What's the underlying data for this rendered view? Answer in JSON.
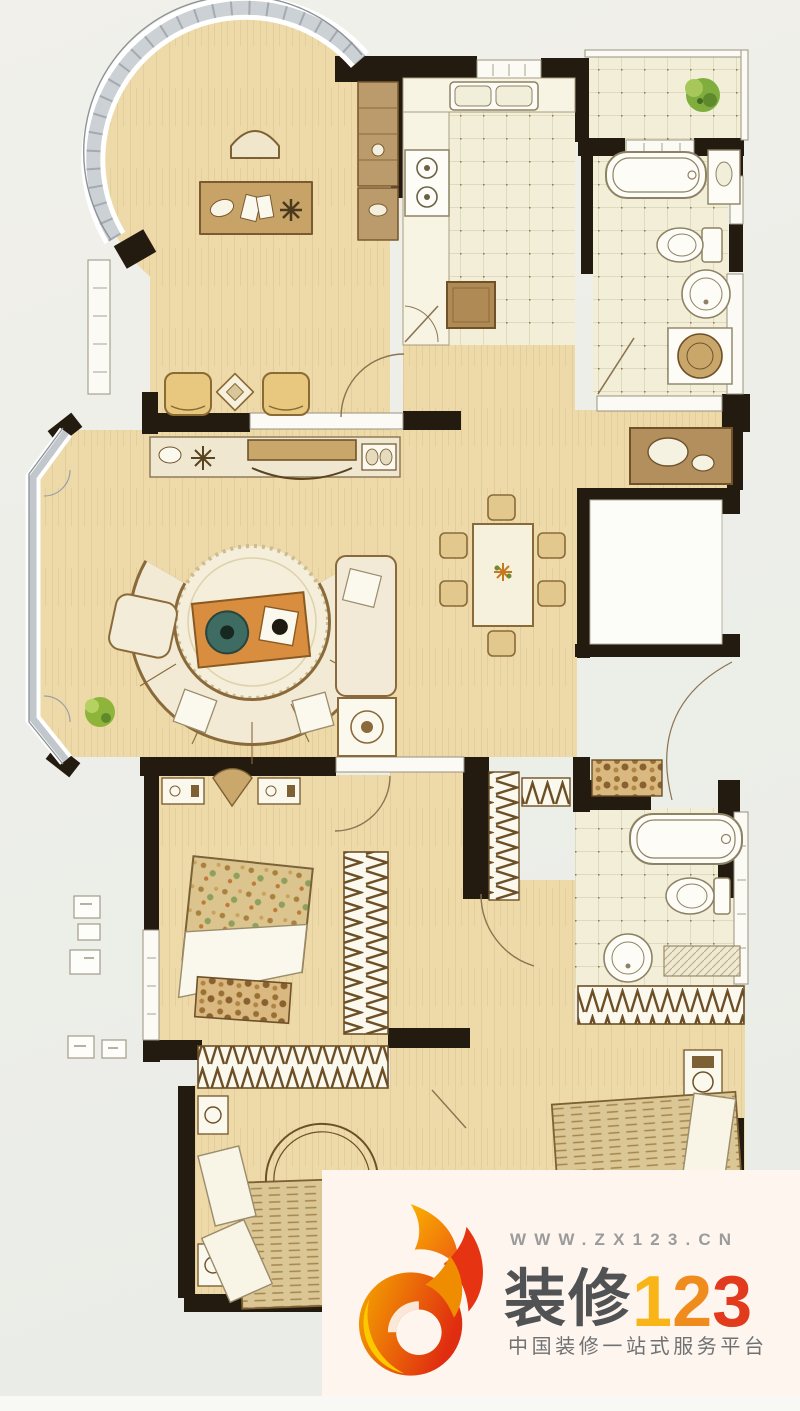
{
  "watermark": {
    "url": "WWW.ZX123.CN",
    "brand_cn": "装修",
    "brand_num_1": "1",
    "brand_num_2": "2",
    "brand_num_3": "3",
    "tagline": "中国装修一站式服务平台",
    "colors": {
      "panel_bg": "#fdf5ee",
      "url_gray": "#9b9b9b",
      "brand_gray": "#515254",
      "num_yellow": "#f9b517",
      "num_orange": "#f08c1e",
      "num_red": "#e23a1c",
      "logo_red": "#e02c10",
      "logo_orange": "#f5a800"
    }
  },
  "floor_plan": {
    "style": "hand-drawn colored apartment floor plan",
    "background": "#edeee9",
    "wall_color": "#231a10",
    "wood_floor_color": "#eed9a9",
    "tile_floor_color": "#f3eed7",
    "rooms": [
      {
        "name": "study",
        "furniture": [
          "desk",
          "desk-chair",
          "two-armchairs",
          "side-table",
          "wall-cabinet",
          "bay-window"
        ]
      },
      {
        "name": "kitchen",
        "furniture": [
          "counter",
          "double-sink",
          "gas-stove",
          "island-table"
        ]
      },
      {
        "name": "balcony",
        "furniture": [
          "potted-plant"
        ]
      },
      {
        "name": "bathroom-1",
        "furniture": [
          "bathtub",
          "vanity",
          "toilet",
          "round-washbasin",
          "washing-machine"
        ]
      },
      {
        "name": "living-room",
        "furniture": [
          "tv-console",
          "curved-sofa",
          "round-rug",
          "coffee-table",
          "armchair",
          "chaise",
          "media-cabinet",
          "potted-plant",
          "bay-window"
        ]
      },
      {
        "name": "dining-room",
        "furniture": [
          "dining-table",
          "six-chairs",
          "sideboard-with-basins"
        ]
      },
      {
        "name": "stairwell-void",
        "furniture": []
      },
      {
        "name": "bedroom-2",
        "furniture": [
          "double-bed",
          "two-nightstands",
          "lamp",
          "bench",
          "wardrobe",
          "closet"
        ]
      },
      {
        "name": "bedroom-3",
        "furniture": [
          "round-headboard-bed",
          "two-nightstands",
          "shared-wardrobe"
        ]
      },
      {
        "name": "master-bathroom",
        "furniture": [
          "bathtub",
          "toilet",
          "round-washbasin",
          "mat",
          "entry-rug"
        ]
      },
      {
        "name": "master-bedroom",
        "furniture": [
          "double-bed",
          "nightstand",
          "wardrobe"
        ]
      }
    ]
  }
}
